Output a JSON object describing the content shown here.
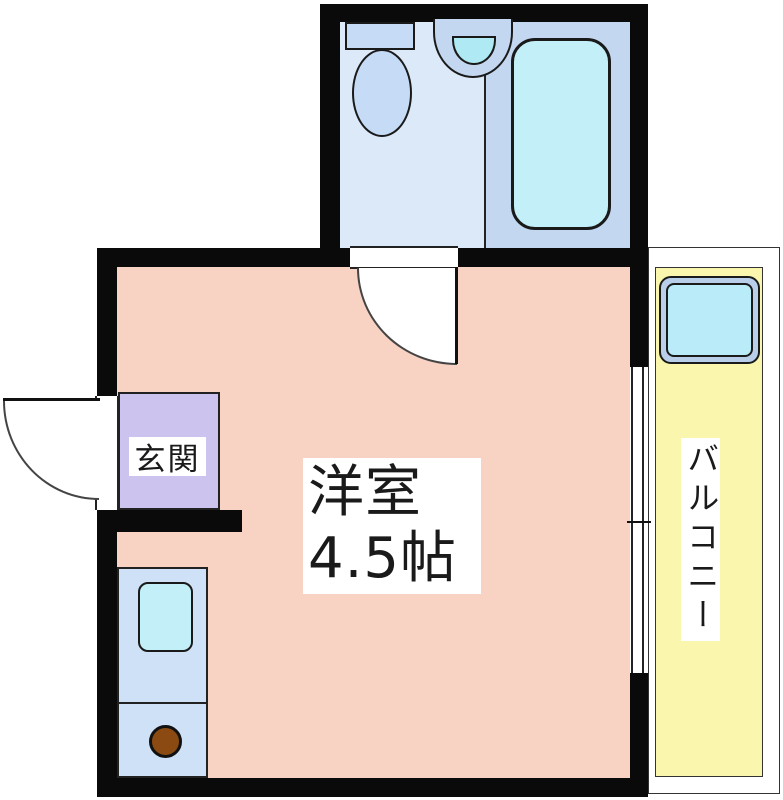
{
  "plan": {
    "type": "apartment-floor-plan",
    "rooms": {
      "main_room": {
        "name": "洋室",
        "size": "4.5帖",
        "floor_color": "#f8d2c2"
      },
      "entrance": {
        "label": "玄関",
        "floor_color": "#cdc3ef"
      },
      "balcony": {
        "label": "バルコニー",
        "floor_color": "#faf6ae"
      },
      "bathroom": {
        "floor_color": "#dce9f9",
        "bath_zone_color": "#c3d8f0"
      },
      "kitchen": {
        "floor_color": "#cfe1f6"
      }
    },
    "fixtures": {
      "toilet": "toilet-icon",
      "wash_basin": "wash-basin-icon",
      "bathtub": "bathtub-icon",
      "kitchen_sink": "kitchen-sink-icon",
      "stove_burner": "single-burner-icon",
      "washing_machine_pan": "washing-machine-pan-icon"
    },
    "colors": {
      "wall": "#0a0a0a",
      "fixture_cyan": "#c3eff8",
      "fixture_blue": "#c6dcf6",
      "pan_frame": "#b9cfe9",
      "burner_brown": "#8a4a12",
      "background": "#ffffff"
    }
  }
}
